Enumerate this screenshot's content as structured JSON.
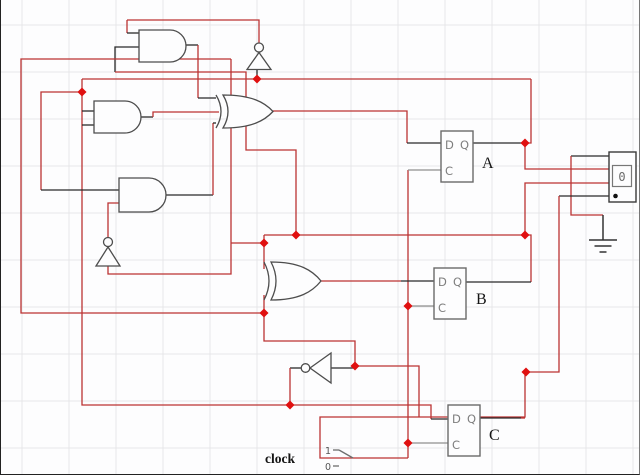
{
  "app": {
    "title": "Logic circuit schematic"
  },
  "canvas": {
    "width": 640,
    "height": 475,
    "grid": {
      "x0": 21,
      "y0": 25,
      "step": 47,
      "color": "#e7e7e9"
    }
  },
  "colors": {
    "r": "#bb3333",
    "k": "#2a2a2a",
    "g": "#8f8f8f",
    "junction": "#e01010",
    "gate": "#4d4d4d",
    "ff_box": "#6a6a6a",
    "ff_text": "#7d7d7d",
    "label": "#151515",
    "display_box": "#3a3a3a"
  },
  "gates": [
    {
      "id": "and-gate-1",
      "type": "and",
      "x": 138,
      "y": 30,
      "w": 47,
      "h": 32
    },
    {
      "id": "and-gate-2",
      "type": "and",
      "x": 93,
      "y": 101,
      "w": 47,
      "h": 32
    },
    {
      "id": "and-gate-3",
      "type": "and",
      "x": 118,
      "y": 178,
      "w": 47,
      "h": 34
    },
    {
      "id": "xor-gate-1",
      "type": "xor",
      "x": 215,
      "y": 95,
      "w": 57,
      "h": 33
    },
    {
      "id": "xor-gate-2",
      "type": "xor",
      "x": 263,
      "y": 262,
      "w": 57,
      "h": 38
    },
    {
      "id": "not-gate-1",
      "type": "not-up",
      "cx": 258,
      "top": 43,
      "half": 12,
      "base": 69.5
    },
    {
      "id": "not-gate-2",
      "type": "not-up",
      "cx": 107,
      "top": 237.5,
      "half": 12,
      "base": 266
    },
    {
      "id": "not-gate-3",
      "type": "not-left",
      "apex_x": 309,
      "right_x": 330,
      "cy": 368,
      "half": 15
    }
  ],
  "flipflops": [
    {
      "id": "flipflop-A",
      "x": 440,
      "y": 131,
      "w": 32,
      "h": 51,
      "label": "A",
      "lx": 481,
      "ly": 168,
      "pins": {
        "d": "D",
        "q": "Q",
        "c": "C"
      }
    },
    {
      "id": "flipflop-B",
      "x": 433,
      "y": 268,
      "w": 32,
      "h": 51,
      "label": "B",
      "lx": 475,
      "ly": 304,
      "pins": {
        "d": "D",
        "q": "Q",
        "c": "C"
      }
    },
    {
      "id": "flipflop-C",
      "x": 447,
      "y": 405,
      "w": 32,
      "h": 51,
      "label": "C",
      "lx": 488,
      "ly": 440,
      "pins": {
        "d": "D",
        "q": "Q",
        "c": "C"
      }
    }
  ],
  "display": {
    "value": "0",
    "outer": {
      "x": 608,
      "y": 152,
      "w": 27,
      "h": 50
    },
    "inner": {
      "x": 611.5,
      "y": 165.5,
      "w": 19,
      "h": 21
    },
    "dot": {
      "x": 614.5,
      "y": 196,
      "r": 2.3
    }
  },
  "ground": {
    "lead": [
      [
        602,
        215
      ],
      [
        602,
        240
      ]
    ],
    "bars": [
      [
        [
          588,
          240
        ],
        [
          616,
          240
        ]
      ],
      [
        [
          593.5,
          246
        ],
        [
          610.5,
          246
        ]
      ],
      [
        [
          598.5,
          252
        ],
        [
          605.5,
          252
        ]
      ]
    ]
  },
  "clock_switch": {
    "label": "clock",
    "label_x": 264,
    "label_y": 463,
    "one": "1",
    "one_x": 330,
    "one_y": 454,
    "zero": "0",
    "zero_x": 330,
    "zero_y": 470,
    "tick_one": [
      [
        332,
        450
      ],
      [
        338,
        450
      ]
    ],
    "tick_zero": [
      [
        332,
        466
      ],
      [
        338,
        466
      ]
    ],
    "lever": [
      [
        338,
        450
      ],
      [
        352,
        458
      ]
    ]
  },
  "wires": [
    {
      "c": "r",
      "pts": [
        [
          126,
          20
        ],
        [
          258,
          20
        ],
        [
          258,
          43
        ]
      ]
    },
    {
      "c": "r",
      "pts": [
        [
          126,
          20
        ],
        [
          126,
          33
        ]
      ]
    },
    {
      "c": "k",
      "pts": [
        [
          126,
          33
        ],
        [
          138,
          33
        ]
      ]
    },
    {
      "c": "k",
      "pts": [
        [
          138,
          47
        ],
        [
          114,
          47
        ],
        [
          114,
          72
        ]
      ]
    },
    {
      "c": "r",
      "pts": [
        [
          114,
          72
        ],
        [
          245,
          72
        ],
        [
          245,
          150
        ],
        [
          295,
          150
        ],
        [
          295,
          235
        ]
      ]
    },
    {
      "c": "r",
      "pts": [
        [
          230,
          59
        ],
        [
          20,
          59
        ],
        [
          20,
          313
        ],
        [
          263,
          313
        ]
      ]
    },
    {
      "c": "r",
      "pts": [
        [
          230,
          59
        ],
        [
          230,
          274
        ],
        [
          107,
          274
        ],
        [
          107,
          266
        ]
      ]
    },
    {
      "c": "r",
      "pts": [
        [
          230,
          243
        ],
        [
          263,
          243
        ]
      ]
    },
    {
      "c": "r",
      "pts": [
        [
          263,
          235
        ],
        [
          263,
          269
        ]
      ]
    },
    {
      "c": "r",
      "pts": [
        [
          263,
          295
        ],
        [
          263,
          341
        ],
        [
          354,
          341
        ],
        [
          354,
          366
        ]
      ]
    },
    {
      "c": "k",
      "pts": [
        [
          330,
          368
        ],
        [
          354,
          368
        ]
      ]
    },
    {
      "c": "r",
      "pts": [
        [
          354,
          366
        ],
        [
          418,
          366
        ],
        [
          418,
          417
        ]
      ]
    },
    {
      "c": "r",
      "pts": [
        [
          81,
          79
        ],
        [
          530,
          79
        ]
      ]
    },
    {
      "c": "k",
      "pts": [
        [
          256,
          70
        ],
        [
          256,
          79
        ]
      ]
    },
    {
      "c": "r",
      "pts": [
        [
          81,
          79
        ],
        [
          81,
          405
        ],
        [
          289,
          405
        ],
        [
          430,
          405
        ],
        [
          430,
          419
        ]
      ]
    },
    {
      "c": "k",
      "pts": [
        [
          430,
          419
        ],
        [
          447,
          419
        ]
      ]
    },
    {
      "c": "r",
      "pts": [
        [
          81,
          92
        ],
        [
          40,
          92
        ],
        [
          40,
          190
        ]
      ]
    },
    {
      "c": "k",
      "pts": [
        [
          40,
          190
        ],
        [
          118,
          190
        ]
      ]
    },
    {
      "c": "k",
      "pts": [
        [
          81,
          111
        ],
        [
          93,
          111
        ]
      ]
    },
    {
      "c": "k",
      "pts": [
        [
          81,
          125
        ],
        [
          93,
          125
        ]
      ]
    },
    {
      "c": "k",
      "pts": [
        [
          301,
          368
        ],
        [
          289,
          368
        ]
      ]
    },
    {
      "c": "r",
      "pts": [
        [
          289,
          368
        ],
        [
          289,
          405
        ]
      ]
    },
    {
      "c": "k",
      "pts": [
        [
          140,
          117
        ],
        [
          152,
          117
        ]
      ]
    },
    {
      "c": "r",
      "pts": [
        [
          152,
          117
        ],
        [
          152,
          112
        ],
        [
          218,
          112
        ]
      ]
    },
    {
      "c": "k",
      "pts": [
        [
          185,
          45
        ],
        [
          197,
          45
        ]
      ]
    },
    {
      "c": "r",
      "pts": [
        [
          197,
          45
        ],
        [
          197,
          98
        ]
      ]
    },
    {
      "c": "k",
      "pts": [
        [
          197,
          98
        ],
        [
          215,
          98
        ]
      ]
    },
    {
      "c": "k",
      "pts": [
        [
          165,
          195
        ],
        [
          212,
          195
        ]
      ]
    },
    {
      "c": "r",
      "pts": [
        [
          212,
          195
        ],
        [
          212,
          123
        ]
      ]
    },
    {
      "c": "k",
      "pts": [
        [
          212,
          123
        ],
        [
          215,
          123
        ]
      ]
    },
    {
      "c": "r",
      "pts": [
        [
          272,
          111
        ],
        [
          406,
          111
        ],
        [
          406,
          143
        ]
      ]
    },
    {
      "c": "k",
      "pts": [
        [
          406,
          143
        ],
        [
          440,
          143
        ]
      ]
    },
    {
      "c": "r",
      "pts": [
        [
          263,
          235
        ],
        [
          524,
          235
        ]
      ]
    },
    {
      "c": "r",
      "pts": [
        [
          524,
          235
        ],
        [
          524,
          183
        ],
        [
          608,
          183
        ]
      ]
    },
    {
      "c": "r",
      "pts": [
        [
          524,
          235
        ],
        [
          530,
          235
        ],
        [
          530,
          282
        ]
      ]
    },
    {
      "c": "k",
      "pts": [
        [
          530,
          282
        ],
        [
          465,
          282
        ]
      ]
    },
    {
      "c": "k",
      "pts": [
        [
          472,
          143
        ],
        [
          524,
          143
        ]
      ]
    },
    {
      "c": "r",
      "pts": [
        [
          530,
          79
        ],
        [
          530,
          143
        ],
        [
          524,
          143
        ],
        [
          524,
          169
        ],
        [
          608,
          169
        ]
      ]
    },
    {
      "c": "k",
      "pts": [
        [
          608,
          156
        ],
        [
          570,
          156
        ]
      ]
    },
    {
      "c": "r",
      "pts": [
        [
          570,
          156
        ],
        [
          570,
          215
        ],
        [
          602,
          215
        ]
      ]
    },
    {
      "c": "k",
      "pts": [
        [
          608,
          196
        ],
        [
          558,
          196
        ]
      ]
    },
    {
      "c": "r",
      "pts": [
        [
          558,
          196
        ],
        [
          558,
          372
        ],
        [
          525,
          372
        ]
      ]
    },
    {
      "c": "r",
      "pts": [
        [
          524,
          372
        ],
        [
          524,
          417
        ],
        [
          319,
          417
        ],
        [
          319,
          458
        ],
        [
          407,
          458
        ]
      ]
    },
    {
      "c": "k",
      "pts": [
        [
          479,
          418
        ],
        [
          520,
          418
        ]
      ]
    },
    {
      "c": "r",
      "pts": [
        [
          520,
          418
        ],
        [
          524,
          418
        ]
      ]
    },
    {
      "c": "r",
      "pts": [
        [
          407,
          170
        ],
        [
          407,
          458
        ]
      ]
    },
    {
      "c": "g",
      "pts": [
        [
          407,
          170
        ],
        [
          440,
          170
        ]
      ]
    },
    {
      "c": "g",
      "pts": [
        [
          407,
          306
        ],
        [
          433,
          306
        ]
      ]
    },
    {
      "c": "g",
      "pts": [
        [
          407,
          443
        ],
        [
          447,
          443
        ]
      ]
    },
    {
      "c": "r",
      "pts": [
        [
          320,
          281
        ],
        [
          400,
          281
        ]
      ]
    },
    {
      "c": "k",
      "pts": [
        [
          400,
          281
        ],
        [
          433,
          281
        ]
      ]
    },
    {
      "c": "r",
      "pts": [
        [
          107,
          237
        ],
        [
          107,
          203
        ],
        [
          118,
          203
        ]
      ]
    }
  ],
  "junctions": [
    [
      256,
      79
    ],
    [
      81,
      92
    ],
    [
      524,
      143
    ],
    [
      295,
      235
    ],
    [
      263,
      243
    ],
    [
      263,
      313
    ],
    [
      354,
      366
    ],
    [
      289,
      405
    ],
    [
      525,
      372
    ],
    [
      407,
      306
    ],
    [
      407,
      443
    ],
    [
      524,
      235
    ]
  ]
}
